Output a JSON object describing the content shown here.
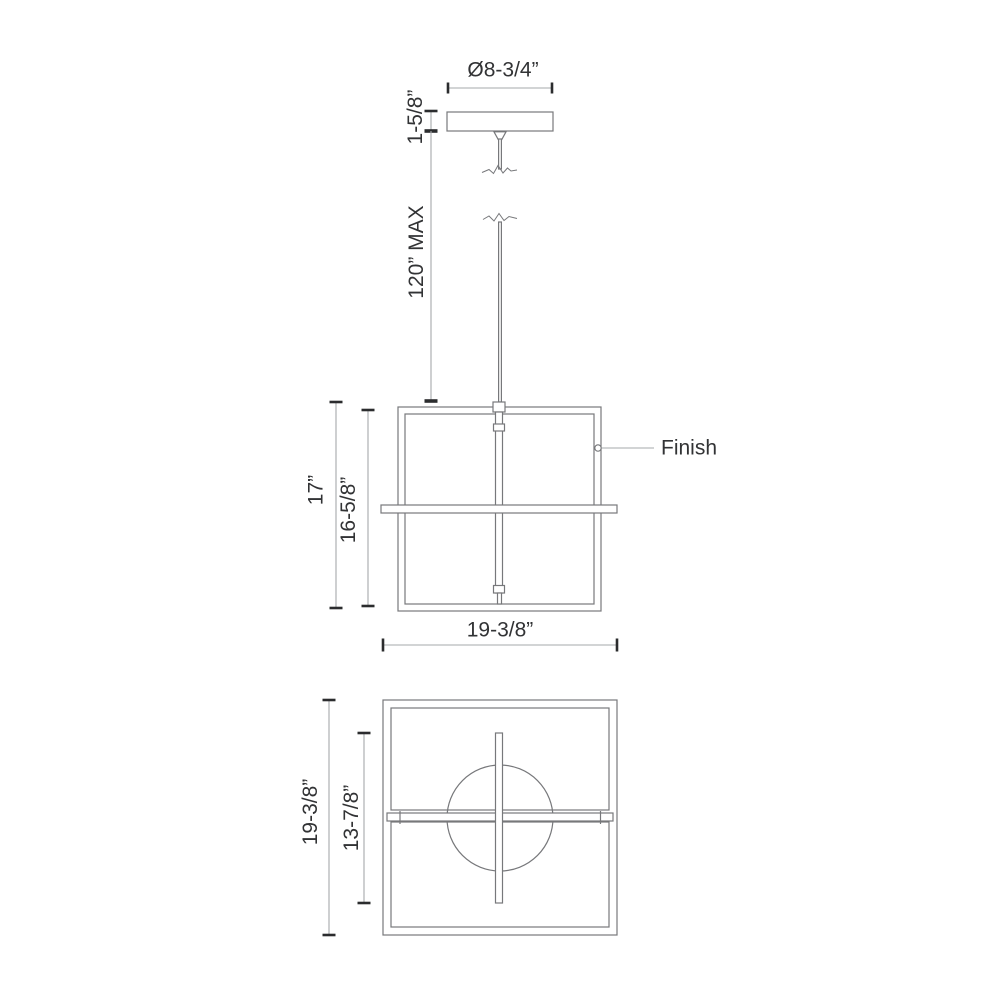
{
  "drawing": {
    "colors": {
      "background": "#ffffff",
      "object_line": "#77787b",
      "dimension_line": "#a6a8ab",
      "tick": "#2b2c2e",
      "text": "#323335"
    },
    "top_view": {
      "canopy_diameter": "Ø8-3/4”",
      "canopy_height": "1-5/8”",
      "suspension_max": "120” MAX"
    },
    "front_view": {
      "overall_height": "17”",
      "frame_height": "16-5/8”",
      "overall_width": "19-3/8”",
      "finish_callout": "Finish"
    },
    "bottom_view": {
      "overall_depth": "19-3/8”",
      "inner_bar_length": "13-7/8”"
    }
  }
}
